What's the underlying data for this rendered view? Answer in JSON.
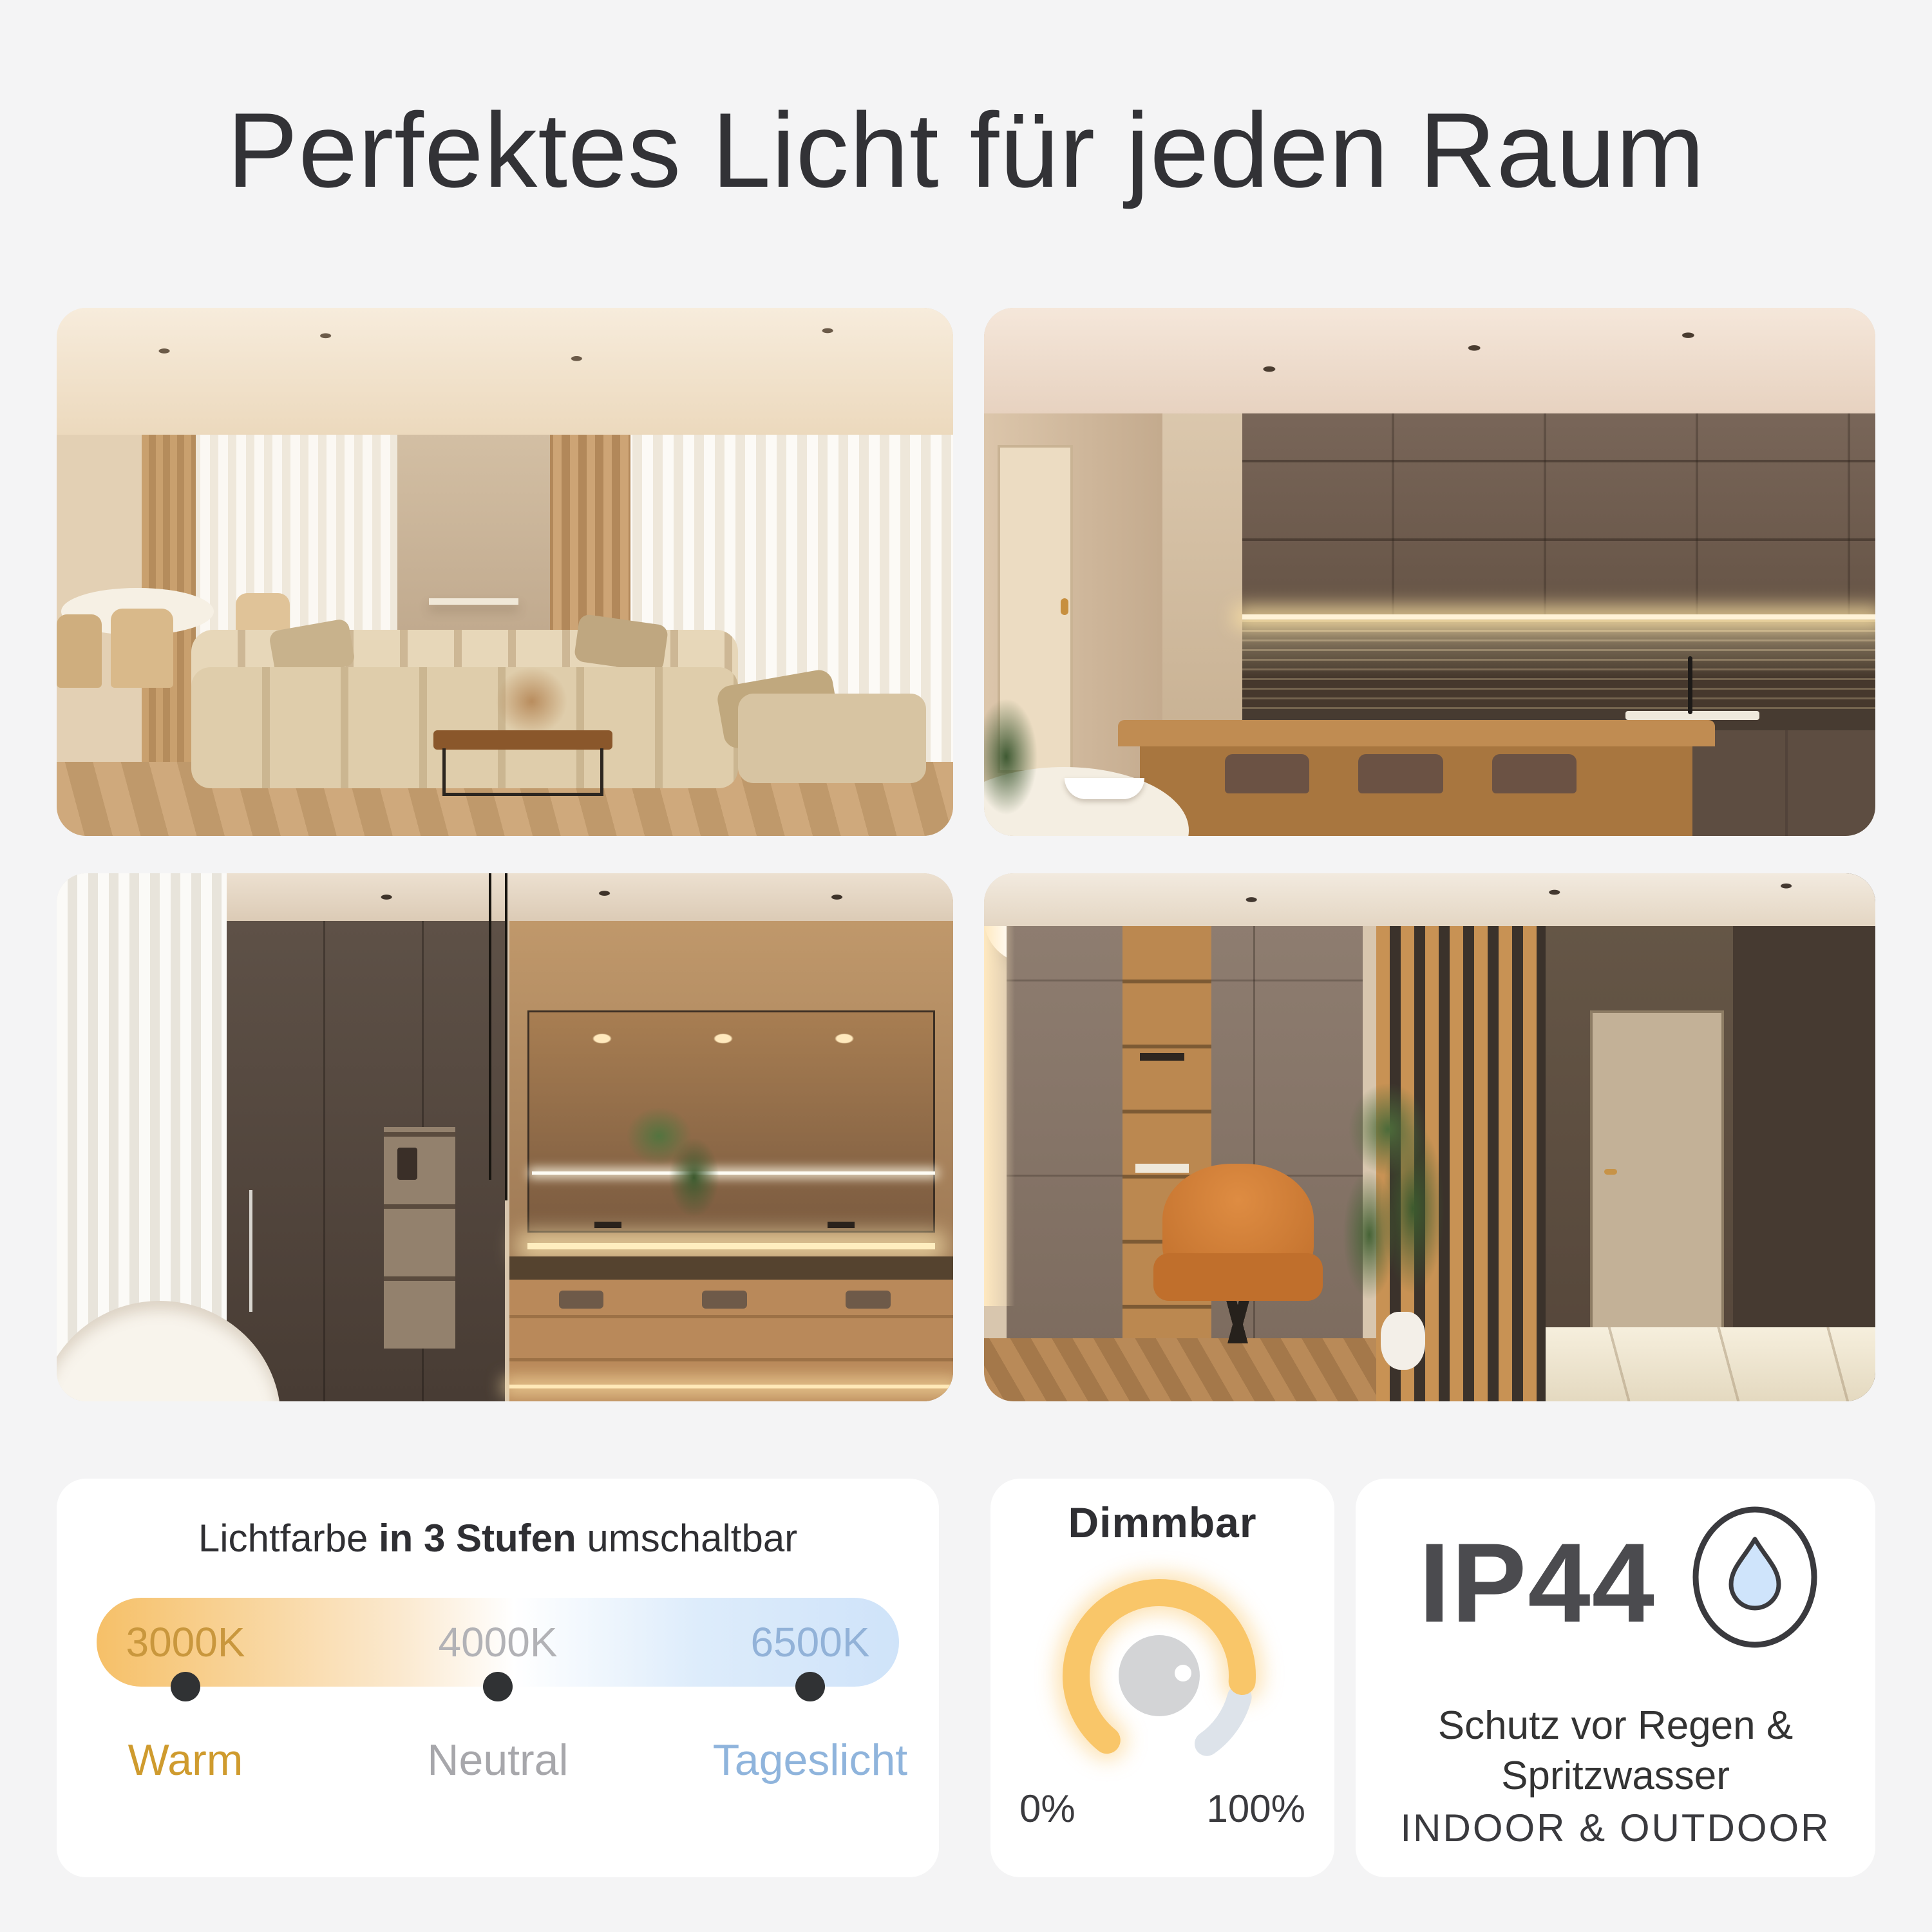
{
  "page": {
    "title": "Perfektes Licht für jeden Raum"
  },
  "rooms": [
    {
      "label": "Wohnzimmer",
      "side": "left"
    },
    {
      "label": "Küche",
      "side": "right"
    },
    {
      "label": "Badezimmer",
      "side": "left"
    },
    {
      "label": "Flur",
      "side": "right"
    }
  ],
  "color_switch": {
    "heading_prefix": "Lichtfarbe ",
    "heading_bold": "in 3 Stufen",
    "heading_suffix": " umschaltbar",
    "steps": [
      {
        "kelvin": "3000K",
        "name": "Warm"
      },
      {
        "kelvin": "4000K",
        "name": "Neutral"
      },
      {
        "kelvin": "6500K",
        "name": "Tageslicht"
      }
    ]
  },
  "dimmer": {
    "title": "Dimmbar",
    "min_label": "0%",
    "max_label": "100%",
    "icon": "dimmer-knob-icon"
  },
  "protection": {
    "rating": "IP44",
    "line1": "Schutz vor Regen &",
    "line2": "Spritzwasser",
    "line3": "INDOOR & OUTDOOR",
    "icon": "water-drop-icon"
  },
  "colors": {
    "bg": "#f4f4f5",
    "title": "#323236",
    "heading": "#2f2f33",
    "pill_text": "#3b3b40",
    "step_warm": "#c9973d",
    "step_neutral": "#b2b2b6",
    "step_daylight": "#92b2d8",
    "warm_label": "#cf9b2e",
    "neutral_label": "#a7a7ab",
    "daylight_label": "#8fb4dc",
    "grad_start": "#f6c068",
    "grad_end": "#cfe3f9",
    "dot": "#303234",
    "arc_active": "#f9c669",
    "arc_rest": "#dde3ea",
    "knob": "#d3d4d6",
    "ip44_text": "#4b4b4f",
    "drop_fill": "#cfe4fb",
    "icon_stroke": "#3a3a3e"
  }
}
